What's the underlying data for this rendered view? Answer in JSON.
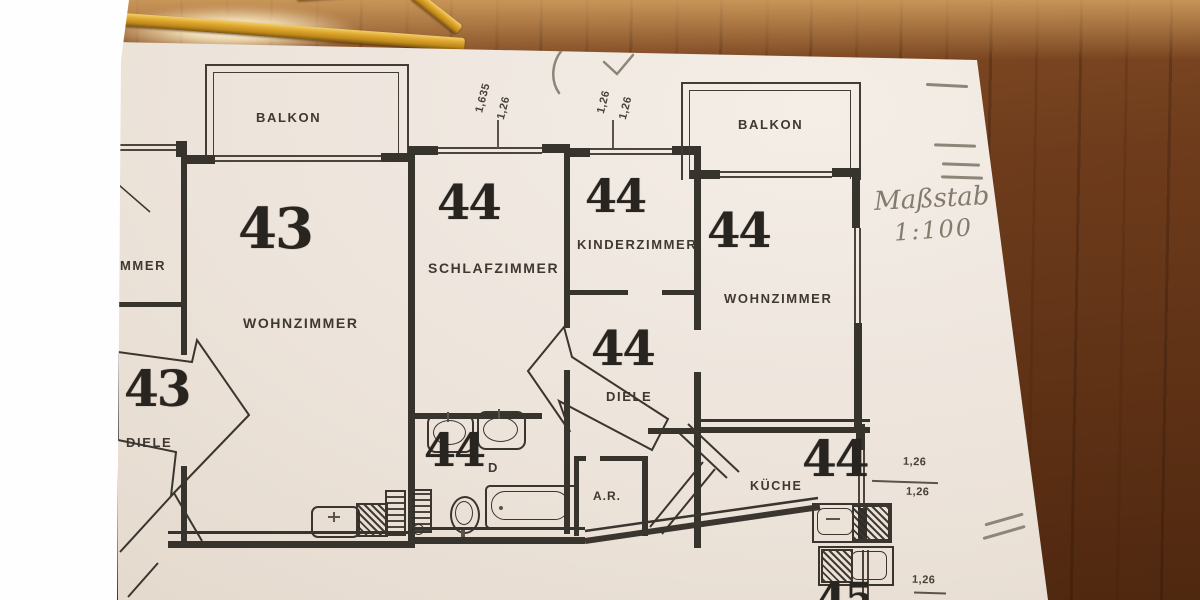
{
  "colors": {
    "wood": "#6e3c1c",
    "wood_highlight": "#f2cf6a",
    "paper": "#ece3da",
    "white_sheet": "#fefefe",
    "ink": "#37332d",
    "stamp_ink": "#28241f",
    "pencil_body": "#dfa72e",
    "pencil_writing": "#837b6e"
  },
  "plan": {
    "balcony_left": {
      "label": "BALKON"
    },
    "balcony_right": {
      "label": "BALKON"
    },
    "room_left_fragment": {
      "label": "MMER"
    },
    "wohnzimmer43": {
      "stamp": "43",
      "label": "WOHNZIMMER"
    },
    "diele43": {
      "stamp": "43",
      "label": "DIELE"
    },
    "schlafzimmer44": {
      "stamp": "44",
      "label": "SCHLAFZIMMER"
    },
    "kinderzimmer44": {
      "stamp": "44",
      "label": "KINDERZIMMER"
    },
    "wohnzimmer44": {
      "stamp": "44",
      "label": "WOHNZIMMER"
    },
    "diele44": {
      "stamp": "44",
      "label": "DIELE"
    },
    "bad44": {
      "stamp": "44",
      "label_fragment": "D"
    },
    "kueche44": {
      "stamp": "44",
      "label": "KÜCHE"
    },
    "abstellraum": {
      "label": "A.R."
    },
    "stamp_bottom_fragment": "45",
    "dims": {
      "left": "1,26",
      "schlaf_a": "1,635",
      "schlaf_b": "1,26",
      "kinder_a": "1,26",
      "kinder_b": "1,26",
      "right_top_a": "1,26",
      "right_top_b": "1,26",
      "right_bottom": "1,26"
    },
    "handwriting": {
      "line1": "Maßstab",
      "line2": "1:100"
    }
  }
}
